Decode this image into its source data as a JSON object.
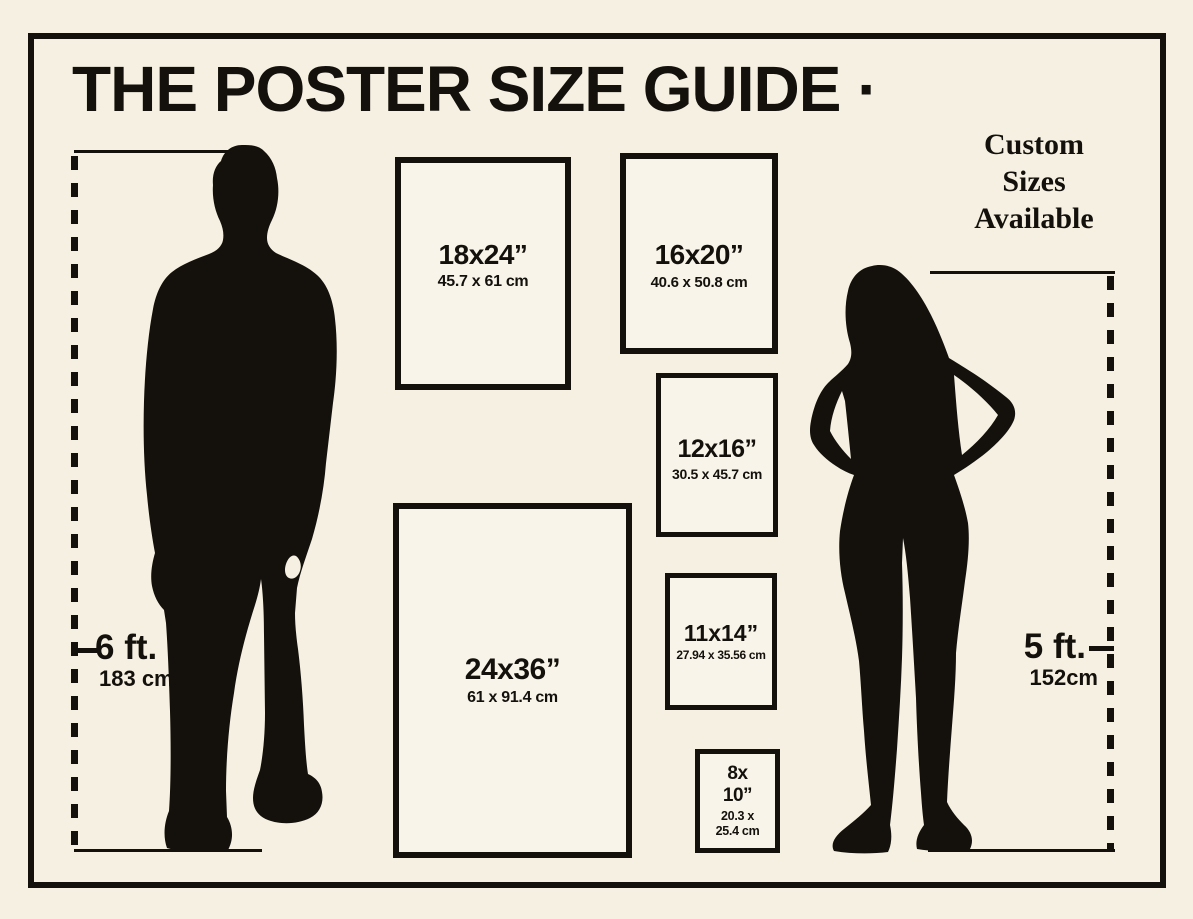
{
  "title": "THE POSTER SIZE GUIDE ·",
  "custom_note": {
    "line1": "Custom",
    "line2": "Sizes",
    "line3": "Available"
  },
  "posters": {
    "p18x24": {
      "size": "18x24”",
      "metric": "45.7 x 61 cm"
    },
    "p16x20": {
      "size": "16x20”",
      "metric": "40.6 x 50.8 cm"
    },
    "p12x16": {
      "size": "12x16”",
      "metric": "30.5 x 45.7 cm"
    },
    "p11x14": {
      "size": "11x14”",
      "metric": "27.94 x 35.56 cm"
    },
    "p24x36": {
      "size": "24x36”",
      "metric": "61 x 91.4 cm"
    },
    "p8x10": {
      "size_line1": "8x",
      "size_line2": "10”",
      "metric_line1": "20.3 x",
      "metric_line2": "25.4 cm"
    }
  },
  "measurements": {
    "male": {
      "height_ft": "6 ft.",
      "height_cm": "183 cm"
    },
    "female": {
      "height_ft": "5 ft.",
      "height_cm": "152cm"
    }
  },
  "figures": {
    "male": "man-silhouette",
    "female": "woman-silhouette"
  },
  "colors": {
    "background": "#f5f0e2",
    "ink": "#14110c",
    "box_fill": "#f8f4ea"
  }
}
